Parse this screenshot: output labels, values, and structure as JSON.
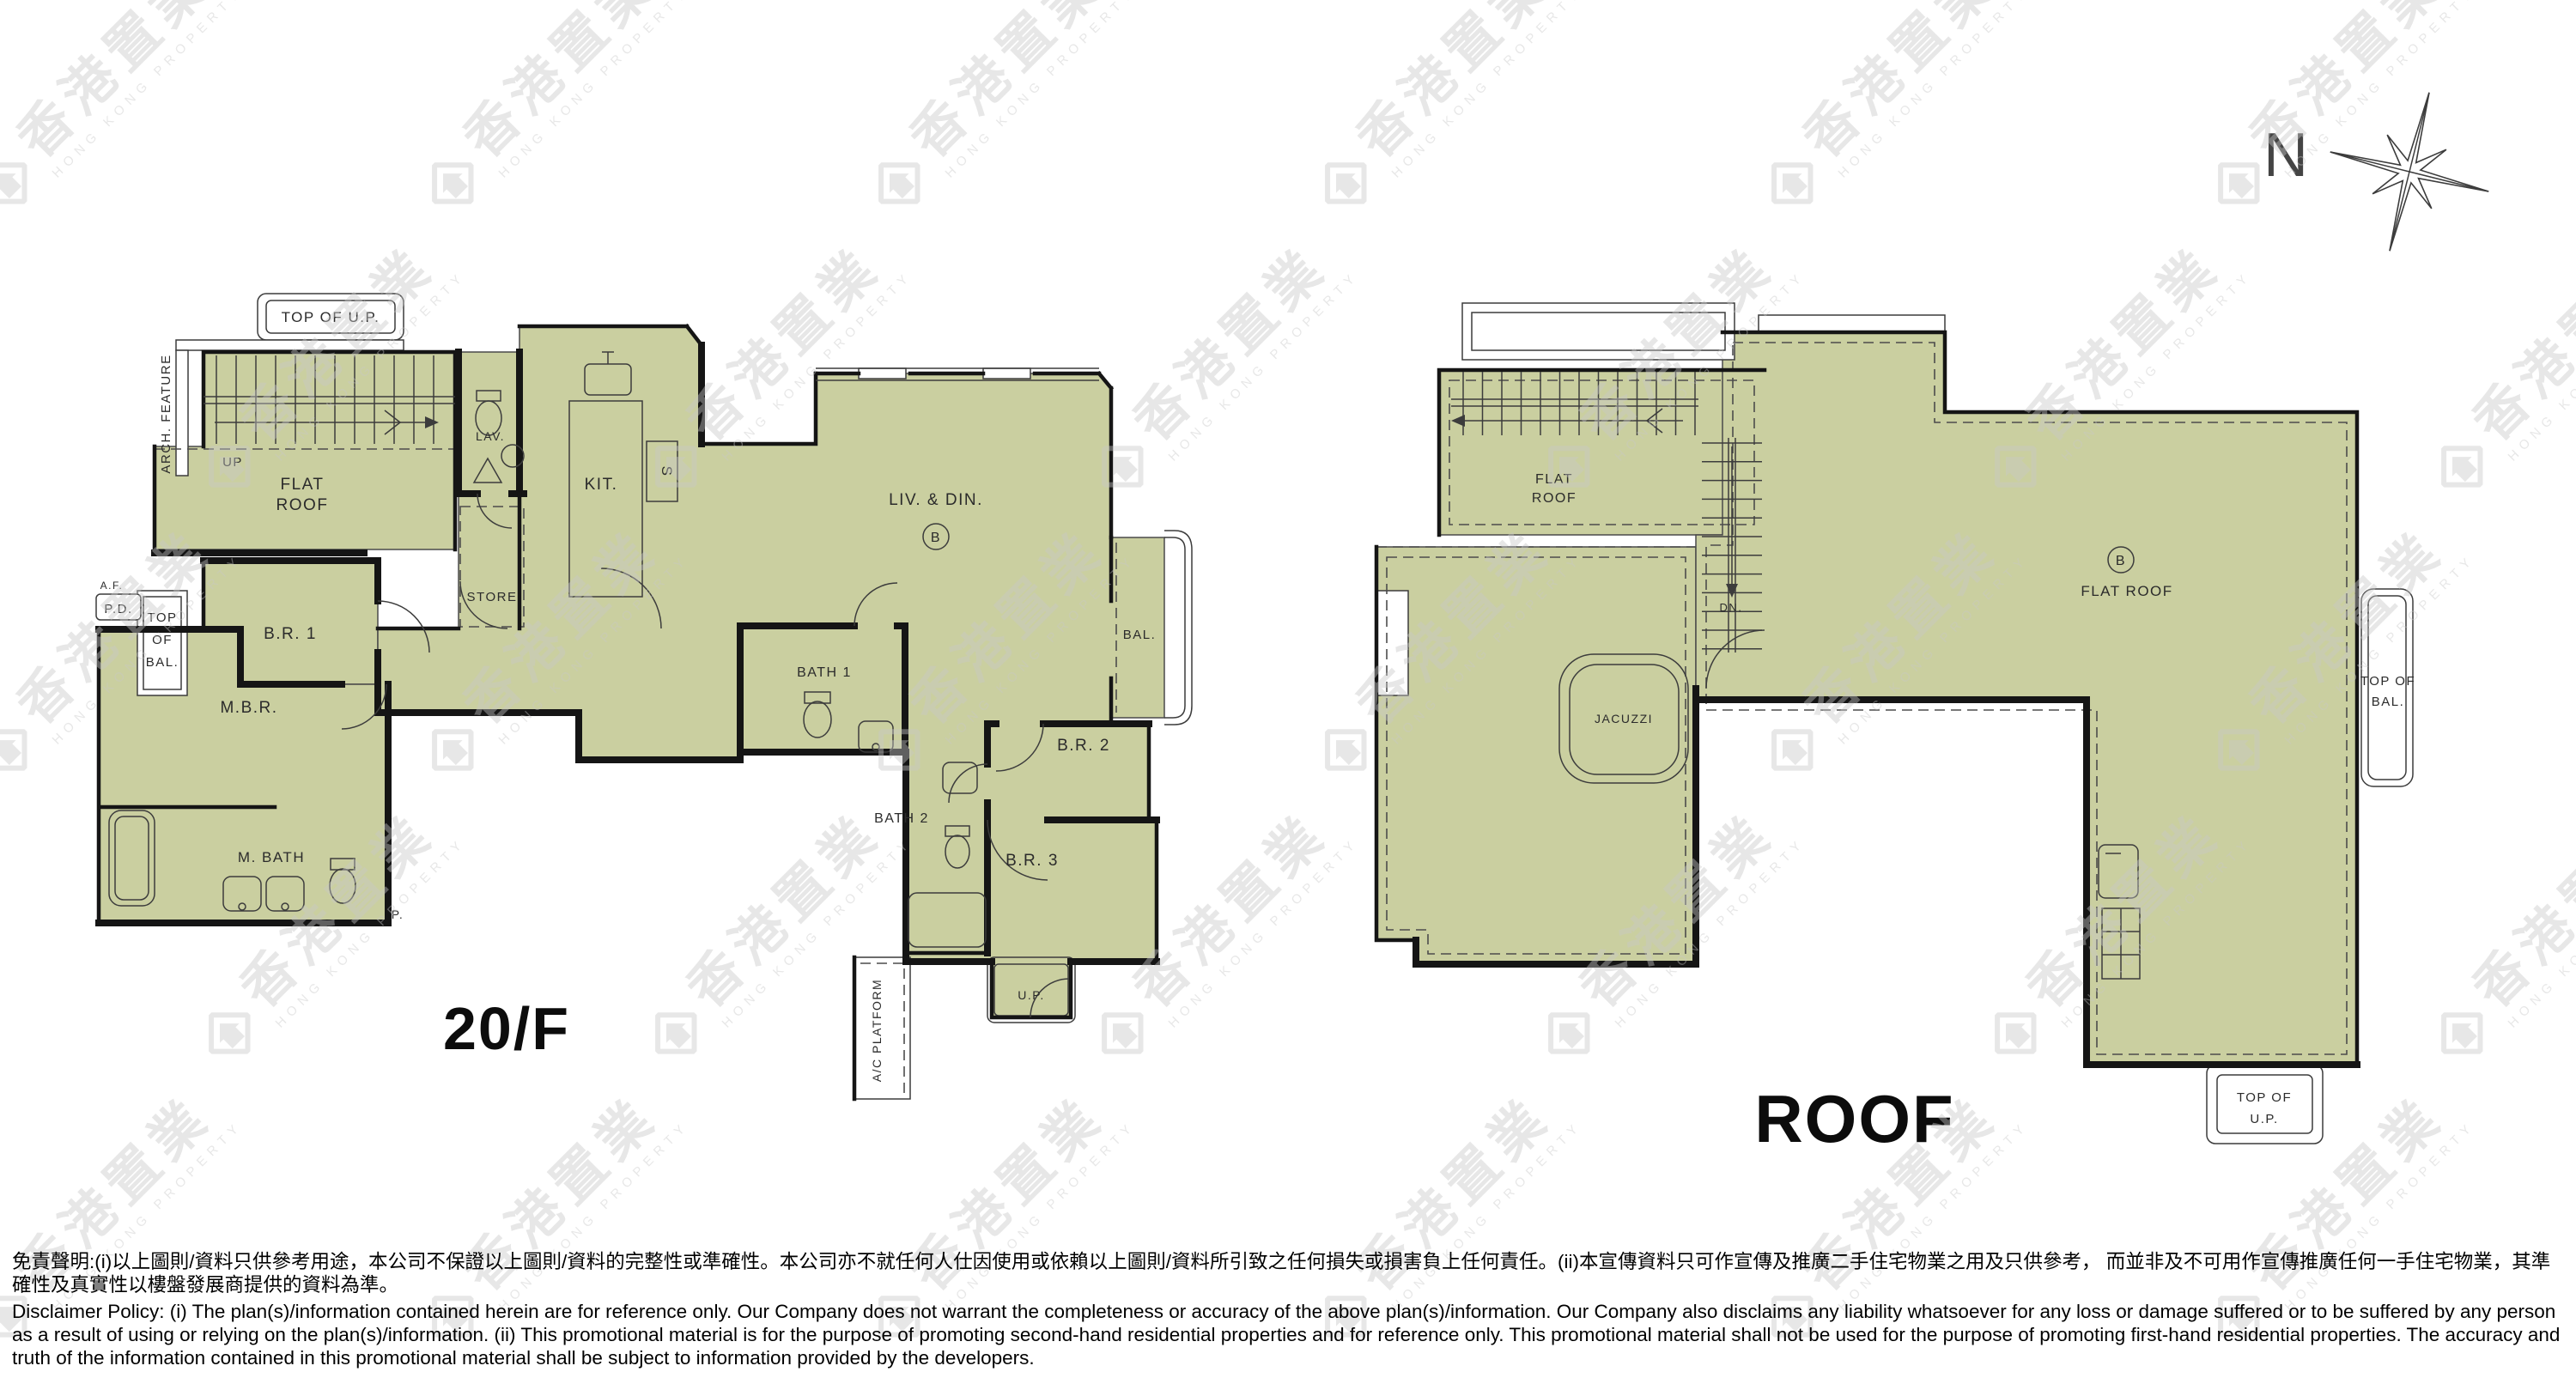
{
  "watermark": {
    "cjk": "香港置業",
    "latin": "HONG KONG PROPERTY"
  },
  "compass": {
    "north": "N"
  },
  "plan20f": {
    "title": "20/F",
    "labels": {
      "top_of_up": "TOP OF U.P.",
      "arch_feature": "ARCH. FEATURE",
      "up": "UP",
      "flat_roof_1": "FLAT",
      "flat_roof_2": "ROOF",
      "br1": "B.R. 1",
      "top_of_bal_1": "TOP",
      "top_of_bal_2": "OF",
      "top_of_bal_3": "BAL.",
      "af": "A.F.",
      "pd": "P.D.",
      "mbr": "M.B.R.",
      "m_bath": "M. BATH",
      "p": "P.",
      "lav": "LAV.",
      "store": "STORE",
      "kit": "KIT.",
      "sink_s": "S",
      "liv_din": "LIV. & DIN.",
      "unit": "B",
      "bal": "BAL.",
      "bath1": "BATH 1",
      "bath2": "BATH 2",
      "br2": "B.R. 2",
      "br3": "B.R. 3",
      "up_small": "U.P.",
      "ac_platform": "A/C PLATFORM"
    }
  },
  "planroof": {
    "title": "ROOF",
    "labels": {
      "flat_roof_1": "FLAT",
      "flat_roof_2": "ROOF",
      "dn": "DN.",
      "jacuzzi": "JACUZZI",
      "unit": "B",
      "flat_roof_main": "FLAT  ROOF",
      "top_of_bal_1": "TOP OF",
      "top_of_bal_2": "BAL.",
      "top_of_up_1": "TOP OF",
      "top_of_up_2": "U.P."
    }
  },
  "colors": {
    "floor": "#cacfa0",
    "wall": "#151515",
    "watermark": "#c8c8c8"
  },
  "disclaimer": {
    "zh": "免責聲明:(i)以上圖則/資料只供參考用途，本公司不保證以上圖則/資料的完整性或準確性。本公司亦不就任何人仕因使用或依賴以上圖則/資料所引致之任何損失或損害負上任何責任。(ii)本宣傳資料只可作宣傳及推廣二手住宅物業之用及只供參考， 而並非及不可用作宣傳推廣任何一手住宅物業，其準確性及真實性以樓盤發展商提供的資料為準。",
    "en": "Disclaimer Policy: (i) The plan(s)/information contained herein are for reference only. Our Company does not warrant the completeness or accuracy of the above plan(s)/information. Our Company also disclaims any liability whatsoever for any loss or damage suffered or to be suffered by any person as a result of using or relying on the plan(s)/information. (ii) This promotional material is for the purpose of promoting second-hand residential properties and for reference only. This promotional material shall not be used for the purpose of promoting first-hand residential properties. The accuracy and truth of the information contained in this promotional material shall be subject to information provided by the developers."
  }
}
